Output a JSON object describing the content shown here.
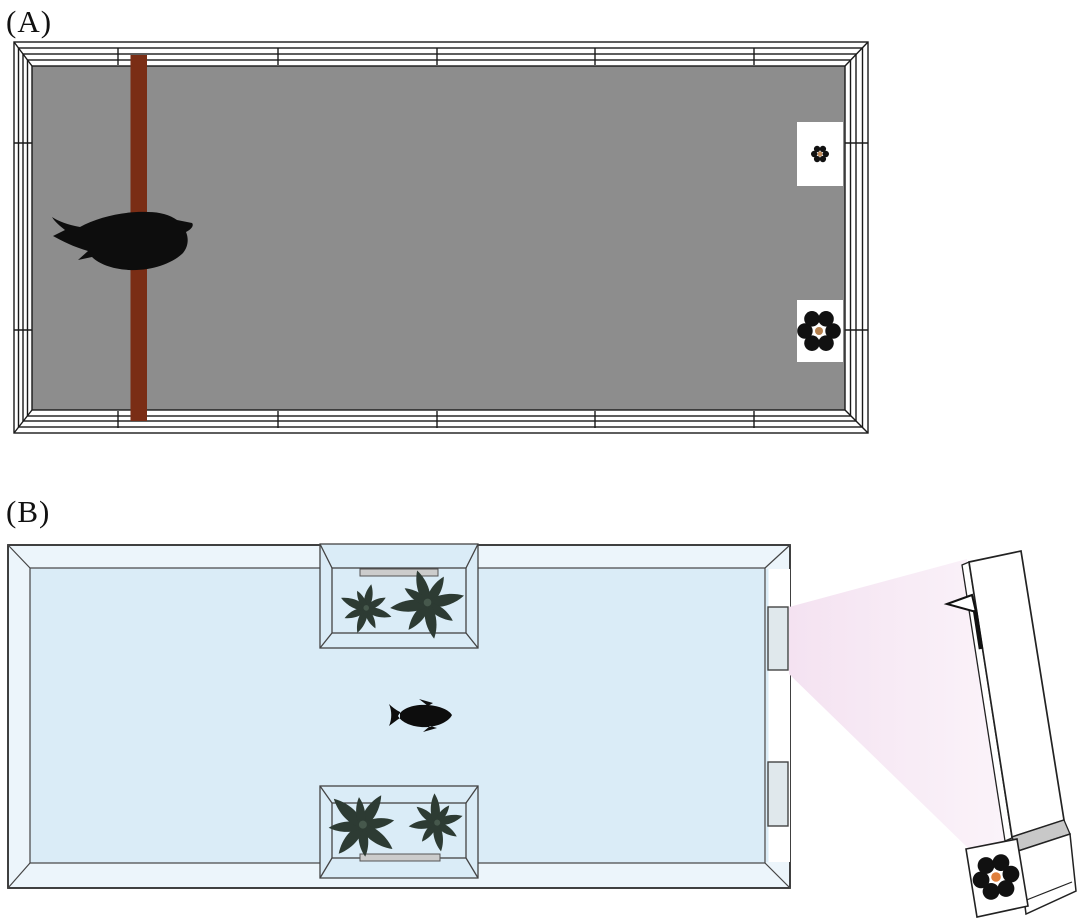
{
  "panels": {
    "a": {
      "label": "(A)",
      "caption": "Aviary top view: bird perched on wooden perch facing two flower stimulus cards on far wall",
      "colors": {
        "floor": "#8d8d8d",
        "perch": "#7a2d15",
        "frame_line": "#1a1a1a",
        "card": "#ffffff",
        "petal": "#111111",
        "flower_center_small": "#c08a58",
        "flower_center_large": "#b5804d",
        "animal": "#0d0d0d"
      }
    },
    "b": {
      "label": "(B)",
      "caption": "Fish tank top view: fish between two plant compartments, viewing windows, light beam to tilted monitor with flower stimulus card",
      "colors": {
        "water": "#daecf7",
        "rim": "#ecf5fb",
        "outline": "#333333",
        "window": "#e0e8ec",
        "bar": "#cccccc",
        "plant": "#2d3b33",
        "beam": "#f5e6f3",
        "device": "#ffffff",
        "device_shade": "#c8c8c8",
        "petal": "#111111",
        "flower_center": "#e07f3c",
        "animal": "#0d0d0d"
      }
    }
  }
}
